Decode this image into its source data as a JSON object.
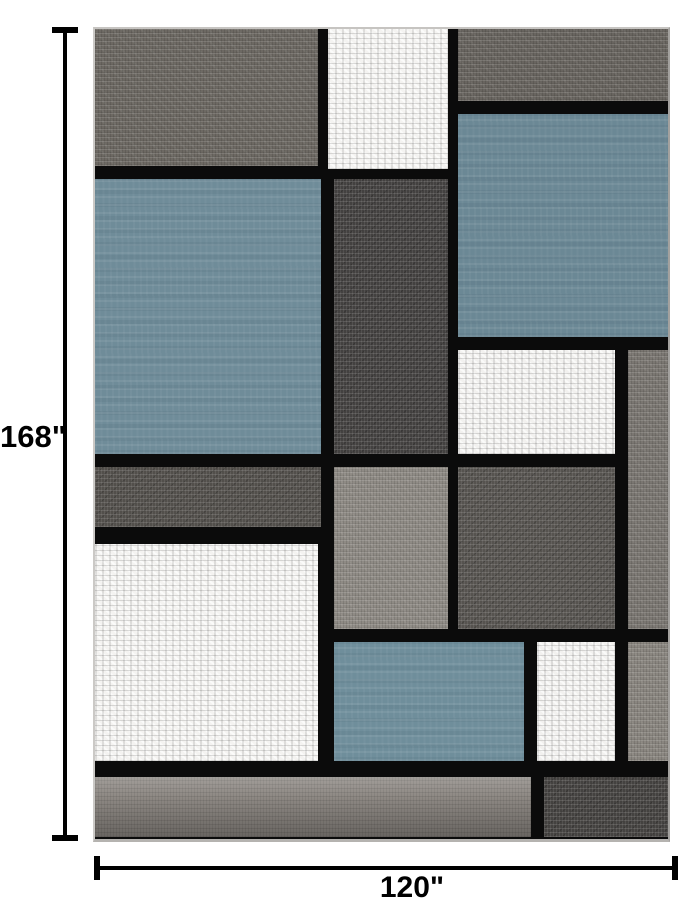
{
  "page": {
    "background": "#ffffff"
  },
  "annotations": {
    "height_label": "168\"",
    "width_label": "120\"",
    "line_color": "#000000"
  },
  "rug": {
    "description": "modern geometric color-block area rug",
    "grid_line_color": "#0b0b0b",
    "edge_color": "#c6c4c1",
    "palette": {
      "slate_blue": "#6b8895",
      "gray": "#6d6963",
      "dark_charcoal": "#434140",
      "light_gray": "#8f8b85",
      "white": "#f4f3f1"
    },
    "blocks": [
      {
        "name": "top-left-gray-block",
        "x": 0,
        "y": 0,
        "w": 223,
        "h": 137,
        "color": "#6d6963",
        "texture": "gray"
      },
      {
        "name": "top-center-white-block",
        "x": 233,
        "y": 0,
        "w": 120,
        "h": 140,
        "color": "#f4f3f1",
        "texture": "white"
      },
      {
        "name": "top-right-gray-block",
        "x": 363,
        "y": 0,
        "w": 210,
        "h": 72,
        "color": "#696560",
        "texture": "gray"
      },
      {
        "name": "right-blue-block",
        "x": 363,
        "y": 85,
        "w": 210,
        "h": 223,
        "color": "#6b8895",
        "texture": "blue"
      },
      {
        "name": "left-blue-block",
        "x": 0,
        "y": 150,
        "w": 226,
        "h": 275,
        "color": "#6f8c99",
        "texture": "blue"
      },
      {
        "name": "center-dark-gray-column",
        "x": 239,
        "y": 150,
        "w": 114,
        "h": 275,
        "color": "#434140",
        "texture": "dark"
      },
      {
        "name": "right-white-block",
        "x": 363,
        "y": 321,
        "w": 157,
        "h": 104,
        "color": "#f2f1ef",
        "texture": "white"
      },
      {
        "name": "right-edge-gray-column-upper",
        "x": 533,
        "y": 321,
        "w": 40,
        "h": 279,
        "color": "#7b7772",
        "texture": "gray"
      },
      {
        "name": "left-gray-strip",
        "x": 0,
        "y": 438,
        "w": 226,
        "h": 60,
        "color": "#524f4b",
        "texture": "dark"
      },
      {
        "name": "center-light-gray-block",
        "x": 239,
        "y": 438,
        "w": 114,
        "h": 162,
        "color": "#8f8b85",
        "texture": "gray"
      },
      {
        "name": "right-dark-gray-block",
        "x": 363,
        "y": 438,
        "w": 157,
        "h": 162,
        "color": "#56534f",
        "texture": "dark"
      },
      {
        "name": "left-white-block",
        "x": 0,
        "y": 515,
        "w": 223,
        "h": 217,
        "color": "#f4f3f1",
        "texture": "white"
      },
      {
        "name": "bottom-blue-block",
        "x": 239,
        "y": 613,
        "w": 190,
        "h": 119,
        "color": "#6f8e9b",
        "texture": "blue"
      },
      {
        "name": "bottom-small-white-block",
        "x": 442,
        "y": 613,
        "w": 78,
        "h": 119,
        "color": "#f2f1ef",
        "texture": "white"
      },
      {
        "name": "right-edge-gray-column-lower",
        "x": 533,
        "y": 613,
        "w": 40,
        "h": 119,
        "color": "#8a8680",
        "texture": "gray"
      },
      {
        "name": "bottom-band-left-gray",
        "x": 0,
        "y": 748,
        "w": 436,
        "h": 60,
        "color": "#8a8580",
        "texture": "band"
      },
      {
        "name": "bottom-band-right-dark",
        "x": 449,
        "y": 748,
        "w": 124,
        "h": 60,
        "color": "#444240",
        "texture": "dark"
      }
    ]
  }
}
